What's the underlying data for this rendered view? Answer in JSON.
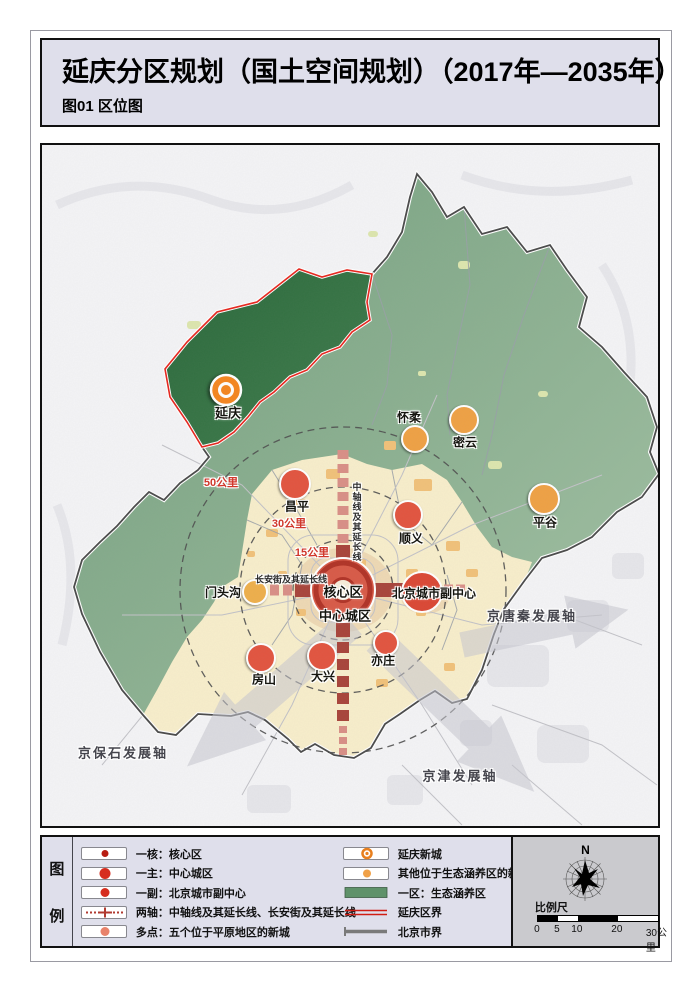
{
  "page": {
    "title": "延庆分区规划（国土空间规划）（2017年—2035年）",
    "subtitle": "图01 区位图"
  },
  "map": {
    "labels": {
      "yanqing": "延庆",
      "huairou": "怀柔",
      "miyun": "密云",
      "pinggu": "平谷",
      "changping": "昌平",
      "shunyi": "顺义",
      "mentougou": "门头沟",
      "core": "核心区",
      "sub_center": "北京城市副中心",
      "central_city": "中心城区",
      "yizhuang": "亦庄",
      "daxing": "大兴",
      "fangshan": "房山",
      "ring15": "15公里",
      "ring30": "30公里",
      "ring50": "50公里",
      "axis_jingbaoshi": "京保石发展轴",
      "axis_jingjin": "京津发展轴",
      "axis_jingtangqin": "京唐秦发展轴",
      "corridor_vertical": "中轴线及其延长线",
      "corridor_horizontal": "长安街及其延长线"
    },
    "colors": {
      "eco_green": "#84ad8a",
      "yanqing_green": "#336f41",
      "plain_cream": "#f8eecb",
      "corridor_red": "#a8443a",
      "new_town_red": "#e2543f",
      "eco_new_town_orange": "#efa144",
      "yanqing_orange": "#f5861f",
      "yanqing_border_red": "#e8251c",
      "beijing_border_gray": "#4a4a4a"
    }
  },
  "legend": {
    "header_chars": [
      "图",
      "例"
    ],
    "left": [
      {
        "type": "dot-core",
        "label": "一核：核心区"
      },
      {
        "type": "dot-main",
        "label": "一主：中心城区"
      },
      {
        "type": "dot-sub",
        "label": "一副：北京城市副中心"
      },
      {
        "type": "axis-line",
        "label": "两轴：中轴线及其延长线、长安街及其延长线"
      },
      {
        "type": "dot-multi",
        "label": "多点：五个位于平原地区的新城"
      }
    ],
    "right": [
      {
        "type": "donut-orange",
        "label": "延庆新城"
      },
      {
        "type": "dot-orange",
        "label": "其他位于生态涵养区的新城"
      },
      {
        "type": "swatch-green",
        "label": "一区：生态涵养区"
      },
      {
        "type": "line-red-double",
        "label": "延庆区界"
      },
      {
        "type": "line-gray",
        "label": "北京市界"
      }
    ]
  },
  "scale": {
    "north": "N",
    "title": "比例尺",
    "ticks": [
      "0",
      "5",
      "10",
      "20",
      "30公里"
    ]
  }
}
